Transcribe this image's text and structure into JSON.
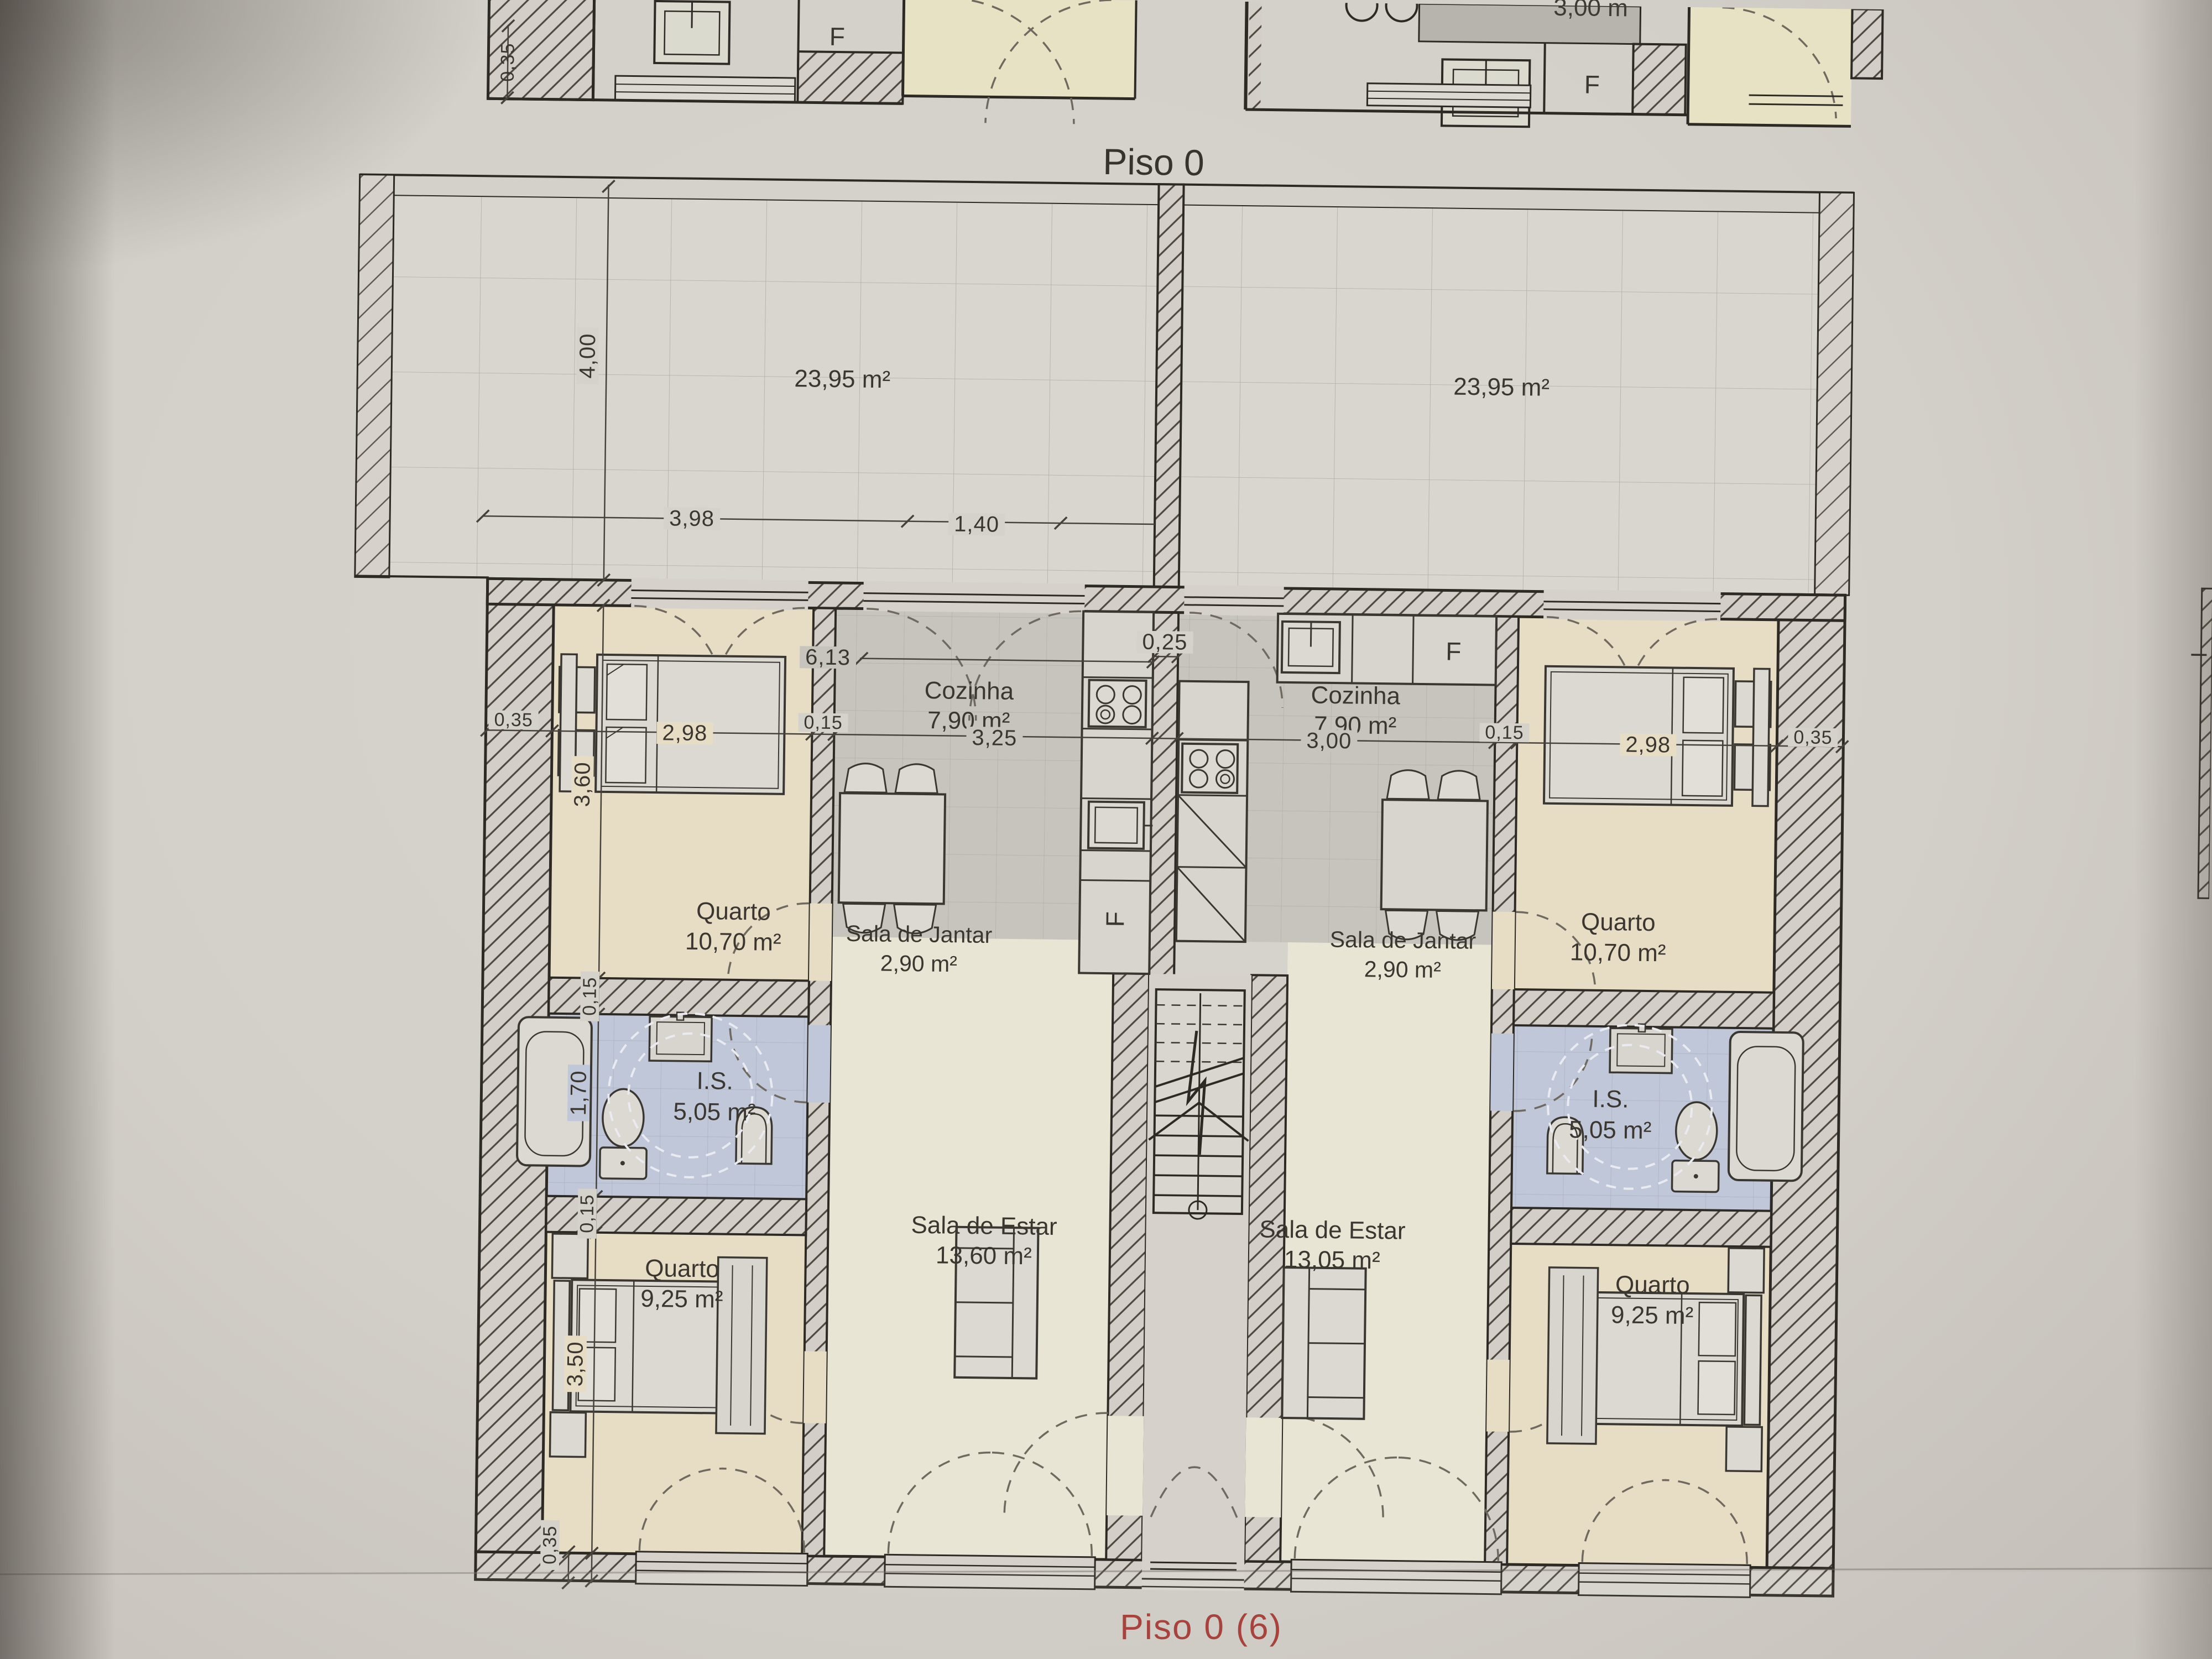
{
  "document": {
    "floor_title": "Piso 0",
    "sheet_footer": "Piso 0 (6)",
    "accent_red": "#a8423c"
  },
  "terraces": {
    "left_area": "23,95 m²",
    "right_area": "23,95 m²"
  },
  "apartment_left": {
    "kitchen": {
      "name": "Cozinha",
      "area": "7,90 m²",
      "fridge_label": "F"
    },
    "dining": {
      "name": "Sala de Jantar",
      "area": "2,90 m²"
    },
    "living": {
      "name": "Sala de Estar",
      "area": "13,60 m²"
    },
    "bedroom_top": {
      "name": "Quarto",
      "area": "10,70 m²"
    },
    "bathroom": {
      "name": "I.S.",
      "area": "5,05 m²"
    },
    "bedroom_bottom": {
      "name": "Quarto",
      "area": "9,25 m²"
    }
  },
  "apartment_right": {
    "kitchen": {
      "name": "Cozinha",
      "area": "7,90 m²",
      "fridge_label": "F"
    },
    "dining": {
      "name": "Sala de Jantar",
      "area": "2,90 m²"
    },
    "living": {
      "name": "Sala de Estar",
      "area": "13,05 m²"
    },
    "bedroom_top": {
      "name": "Quarto",
      "area": "10,70 m²"
    },
    "bathroom": {
      "name": "I.S.",
      "area": "5,05 m²"
    },
    "bedroom_bottom": {
      "name": "Quarto",
      "area": "9,25 m²"
    }
  },
  "upper_floor_strip": {
    "fridge_left": "F",
    "fridge_right": "F",
    "counter_text": "3,00 m",
    "dim_wall": "0,35"
  },
  "dimensions": {
    "terrace_depth": "4,00",
    "terrace_w1": "3,98",
    "terrace_w2": "1,40",
    "total_width": "6,13",
    "center_wall": "0,25",
    "left_wall": "0,35",
    "bed_left_w": "2,98",
    "wall_left": "0,15",
    "kitchen_left_w": "3,25",
    "kitchen_right_w": "3,00",
    "wall_right": "0,15",
    "bed_right_w": "2,98",
    "right_wall": "0,35",
    "bed_left_h": "3,60",
    "bath_wall_top": "0,15",
    "bath_h": "1,70",
    "bath_wall_bottom": "0,15",
    "bed_bottom_h": "3,50",
    "bottom_wall": "0,35"
  }
}
